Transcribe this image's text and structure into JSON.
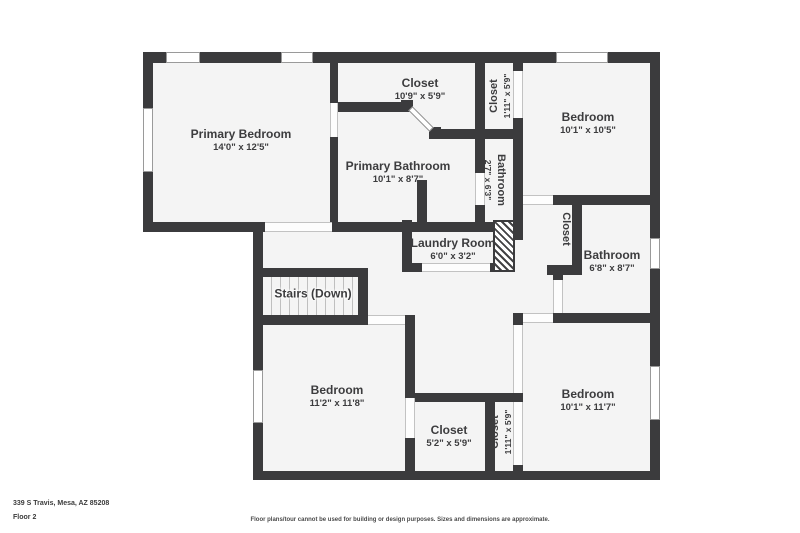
{
  "colors": {
    "wall": "#3b3b3d",
    "floor": "#f4f4f4",
    "page": "#ffffff",
    "text": "#3c3c3e"
  },
  "rooms": [
    {
      "id": "primary-bedroom",
      "name": "Primary Bedroom",
      "dims": "14'0\" x 12'5\""
    },
    {
      "id": "closet-primary",
      "name": "Closet",
      "dims": "10'9\" x 5'9\""
    },
    {
      "id": "closet-top-strip",
      "name": "Closet",
      "dims": "1'11\" x 5'9\""
    },
    {
      "id": "bedroom-top-right",
      "name": "Bedroom",
      "dims": "10'1\" x 10'5\""
    },
    {
      "id": "primary-bathroom",
      "name": "Primary Bathroom",
      "dims": "10'1\" x 8'7\""
    },
    {
      "id": "bathroom-strip",
      "name": "Bathroom",
      "dims": "2'7\" x 6'3\""
    },
    {
      "id": "closet-mid-right",
      "name": "Closet",
      "dims": ""
    },
    {
      "id": "bathroom-right",
      "name": "Bathroom",
      "dims": "6'8\" x 8'7\""
    },
    {
      "id": "laundry-room",
      "name": "Laundry Room",
      "dims": "6'0\" x 3'2\""
    },
    {
      "id": "stairs",
      "name": "Stairs (Down)",
      "dims": ""
    },
    {
      "id": "bedroom-bottom-left",
      "name": "Bedroom",
      "dims": "11'2\" x 11'8\""
    },
    {
      "id": "closet-bottom",
      "name": "Closet",
      "dims": "5'2\" x 5'9\""
    },
    {
      "id": "closet-bottom-strip",
      "name": "Closet",
      "dims": "1'11\" x 5'9\""
    },
    {
      "id": "bedroom-bottom-right",
      "name": "Bedroom",
      "dims": "10'1\" x 11'7\""
    }
  ],
  "footer": {
    "address": "339 S Travis, Mesa, AZ 85208",
    "floor": "Floor 2",
    "disclaimer": "Floor plans/tour cannot be used for building or design purposes. Sizes and dimensions are approximate."
  }
}
